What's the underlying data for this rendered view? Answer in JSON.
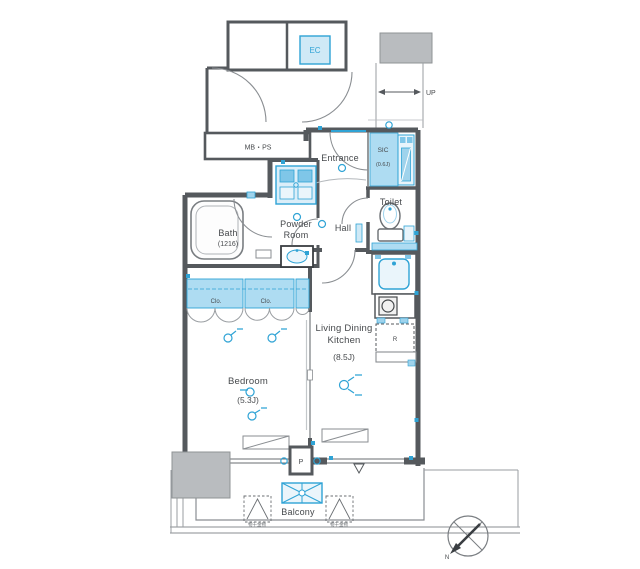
{
  "floorplan": {
    "common": {
      "elevator": "EC",
      "stairs_up": "UP",
      "meter_pipe_space": "MB・PS"
    },
    "rooms": {
      "entrance": {
        "name": "Entrance"
      },
      "shoe_closet": {
        "name": "SIC",
        "size": "(0.6J)"
      },
      "toilet": {
        "name": "Toilet"
      },
      "hall": {
        "name": "Hall"
      },
      "powder_room": {
        "name_line1": "Powder",
        "name_line2": "Room"
      },
      "bath": {
        "name": "Bath",
        "size": "(1216)"
      },
      "closet_left": {
        "name": "Clo."
      },
      "closet_right": {
        "name": "Clo."
      },
      "bedroom": {
        "name": "Bedroom",
        "size": "(5.3J)"
      },
      "ldk": {
        "name_line1": "Living Dining",
        "name_line2": "Kitchen",
        "size": "(8.5J)"
      },
      "balcony": {
        "name": "Balcony"
      }
    },
    "symbols": {
      "refrigerator": "R",
      "pillar": "P",
      "drying_bracket_left": "物干金物",
      "drying_bracket_right": "物干金物",
      "north": "N"
    },
    "colors": {
      "wall": "#55595d",
      "thin_line": "#8a8e92",
      "fixture_blue": "#2fa3d5",
      "fixture_fill": "#cfe9f6",
      "shaded_fill": "#aedcf2",
      "gray_block": "#b9bcbf",
      "text": "#46494c"
    }
  }
}
